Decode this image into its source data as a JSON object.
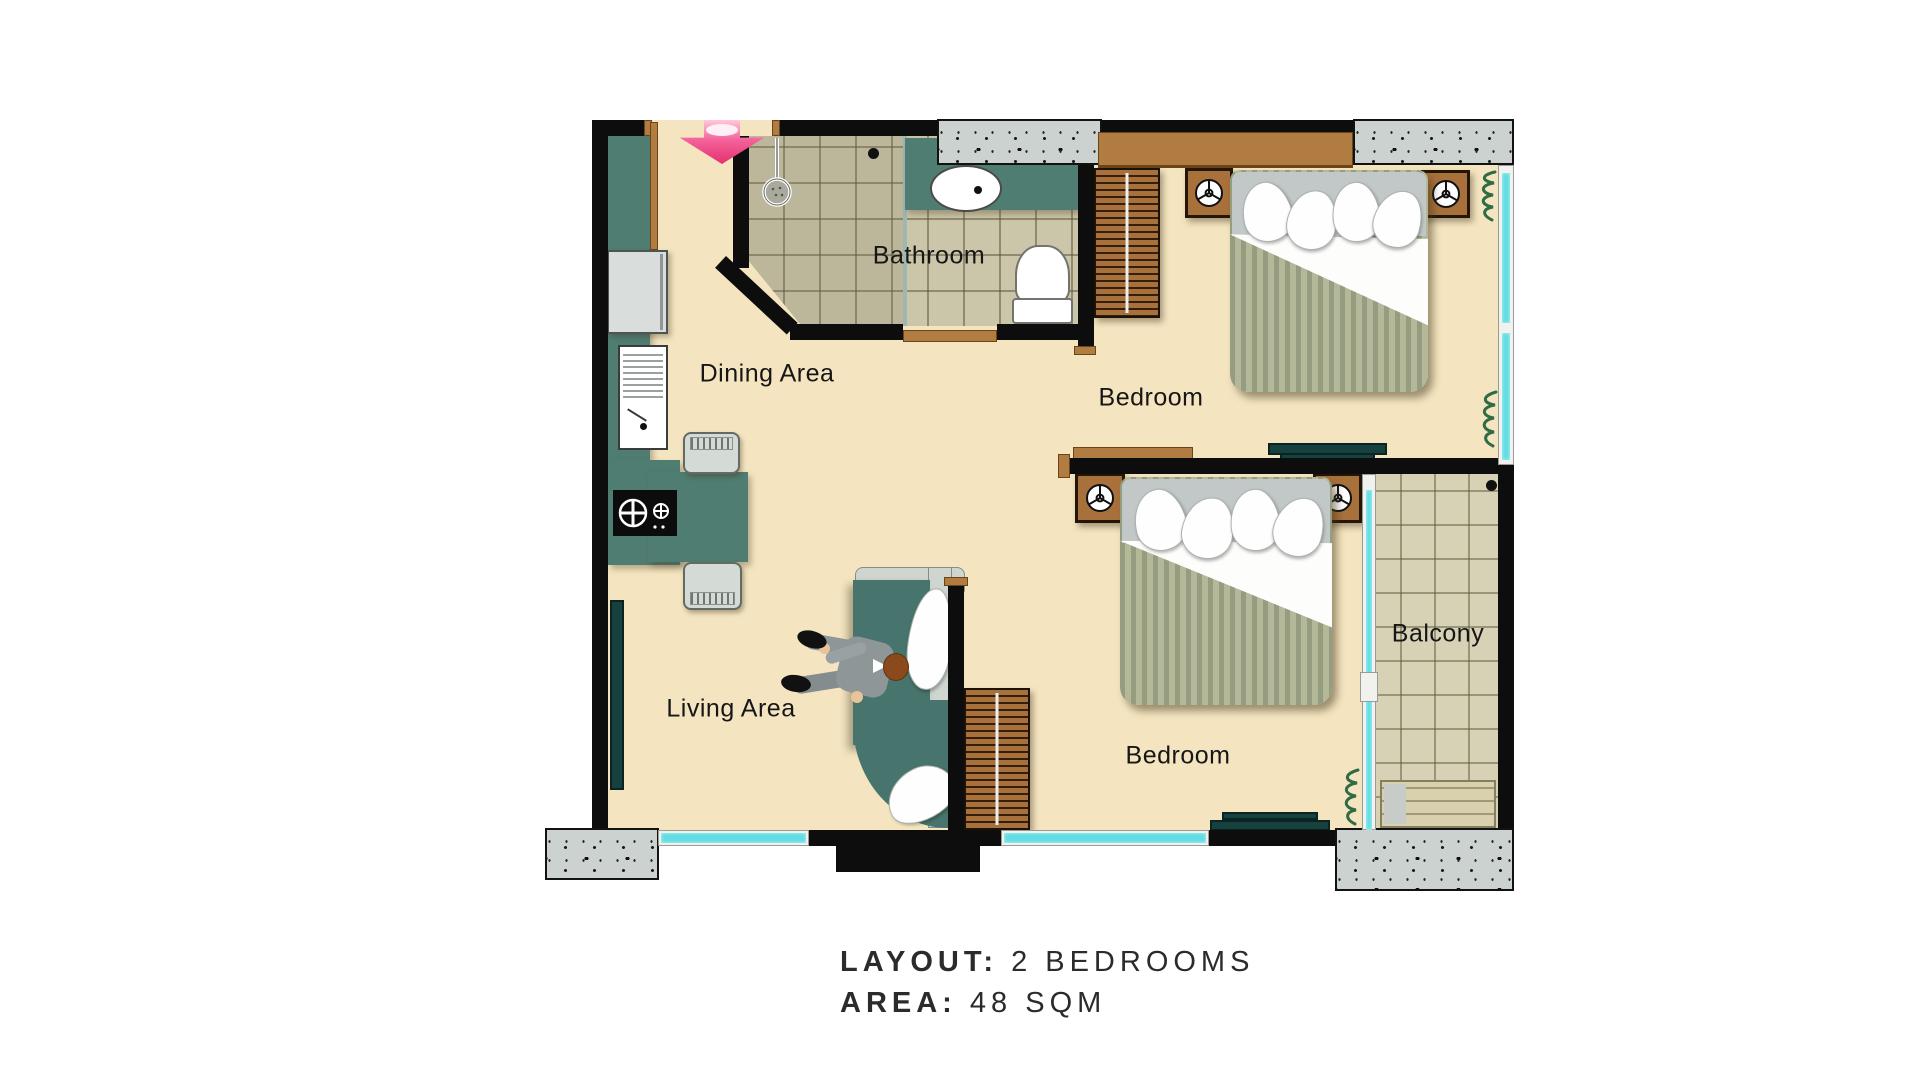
{
  "rooms": {
    "bathroom": "Bathroom",
    "dining": "Dining Area",
    "bedroom_top": "Bedroom",
    "bedroom_bottom": "Bedroom",
    "living": "Living Area",
    "balcony": "Balcony"
  },
  "caption": {
    "layout_label": "LAYOUT:",
    "layout_value": "2 BEDROOMS",
    "area_label": "AREA:",
    "area_value": "48 SQM"
  },
  "colors": {
    "wall": "#0d0d0d",
    "floor": "#f4e5c0",
    "counter_teal": "#4f7d72",
    "wood_brown": "#b07c42",
    "wardrobe_brown": "#a8713c",
    "window_cyan": "#63dde2",
    "concrete_gray": "#ccd2d0",
    "bath_tile": "#cbc5a9",
    "balcony_tile": "#d7d2b5",
    "duvet_sage": "#a9ae92",
    "entrance_arrow_pink": "#e3326f",
    "plant_green": "#2f6b45",
    "text": "#2b2b2b"
  },
  "icons": {
    "entrance": "entrance-arrow-icon",
    "shower": "shower-head-icon",
    "bedside_lamp": "bedside-lamp-icon",
    "stove_burner": "stove-burner-icon",
    "plant": "plant-icon",
    "drain": "drain-icon",
    "faucet": "faucet-icon"
  }
}
